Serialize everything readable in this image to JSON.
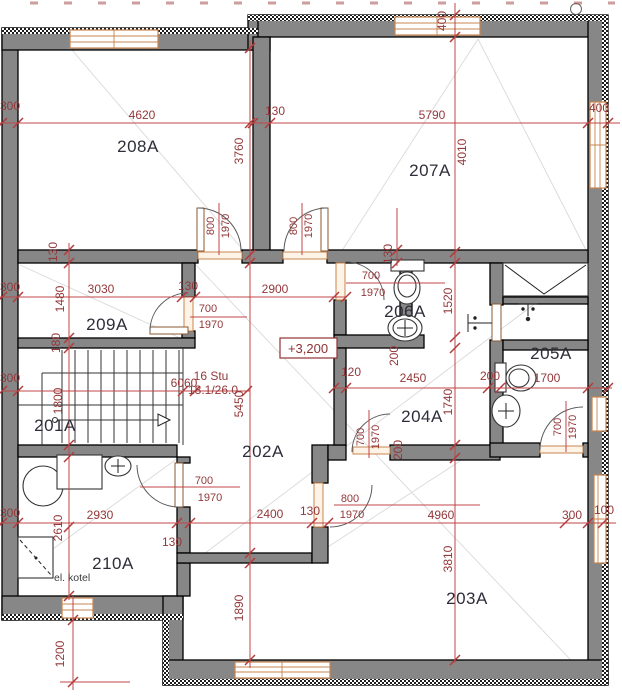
{
  "colors": {
    "wall_fill": "#878787",
    "dim_line": "#c24444",
    "dim_text": "#93383a",
    "joinery_accent": "#c8854f",
    "room_text": "#2e2e3a"
  },
  "rooms": {
    "r201": "201A",
    "r202": "202A",
    "r203": "203A",
    "r204": "204A",
    "r205": "205A",
    "r206": "206A",
    "r207": "207A",
    "r208": "208A",
    "r209": "209A",
    "r210": "210A"
  },
  "doors": {
    "std_w": "700",
    "std_h": "1970",
    "wide_w": "800",
    "wide_h": "1970"
  },
  "stair": {
    "steps": "16 Stu",
    "rise_run": "18.1/26.0"
  },
  "annotations": {
    "level": "+3,200",
    "boiler": "el. kotel"
  },
  "dims": {
    "d4620": "4620",
    "d130": "130",
    "d5790": "5790",
    "d400": "400",
    "d300": "300",
    "d3760": "3760",
    "d4010": "4010",
    "d3030": "3030",
    "d2900": "2900",
    "d1480": "1480",
    "d180": "180",
    "d1520": "1520",
    "d6060": "6060",
    "d5450": "5450",
    "d1800": "1800",
    "d120": "120",
    "d2450": "2450",
    "d1740": "1740",
    "d200": "200",
    "d1700": "1700",
    "d2930": "2930",
    "d2610": "2610",
    "d2400": "2400",
    "d4960": "4960",
    "d100": "100",
    "d3810": "3810",
    "d1890": "1890",
    "d1200": "1200"
  }
}
